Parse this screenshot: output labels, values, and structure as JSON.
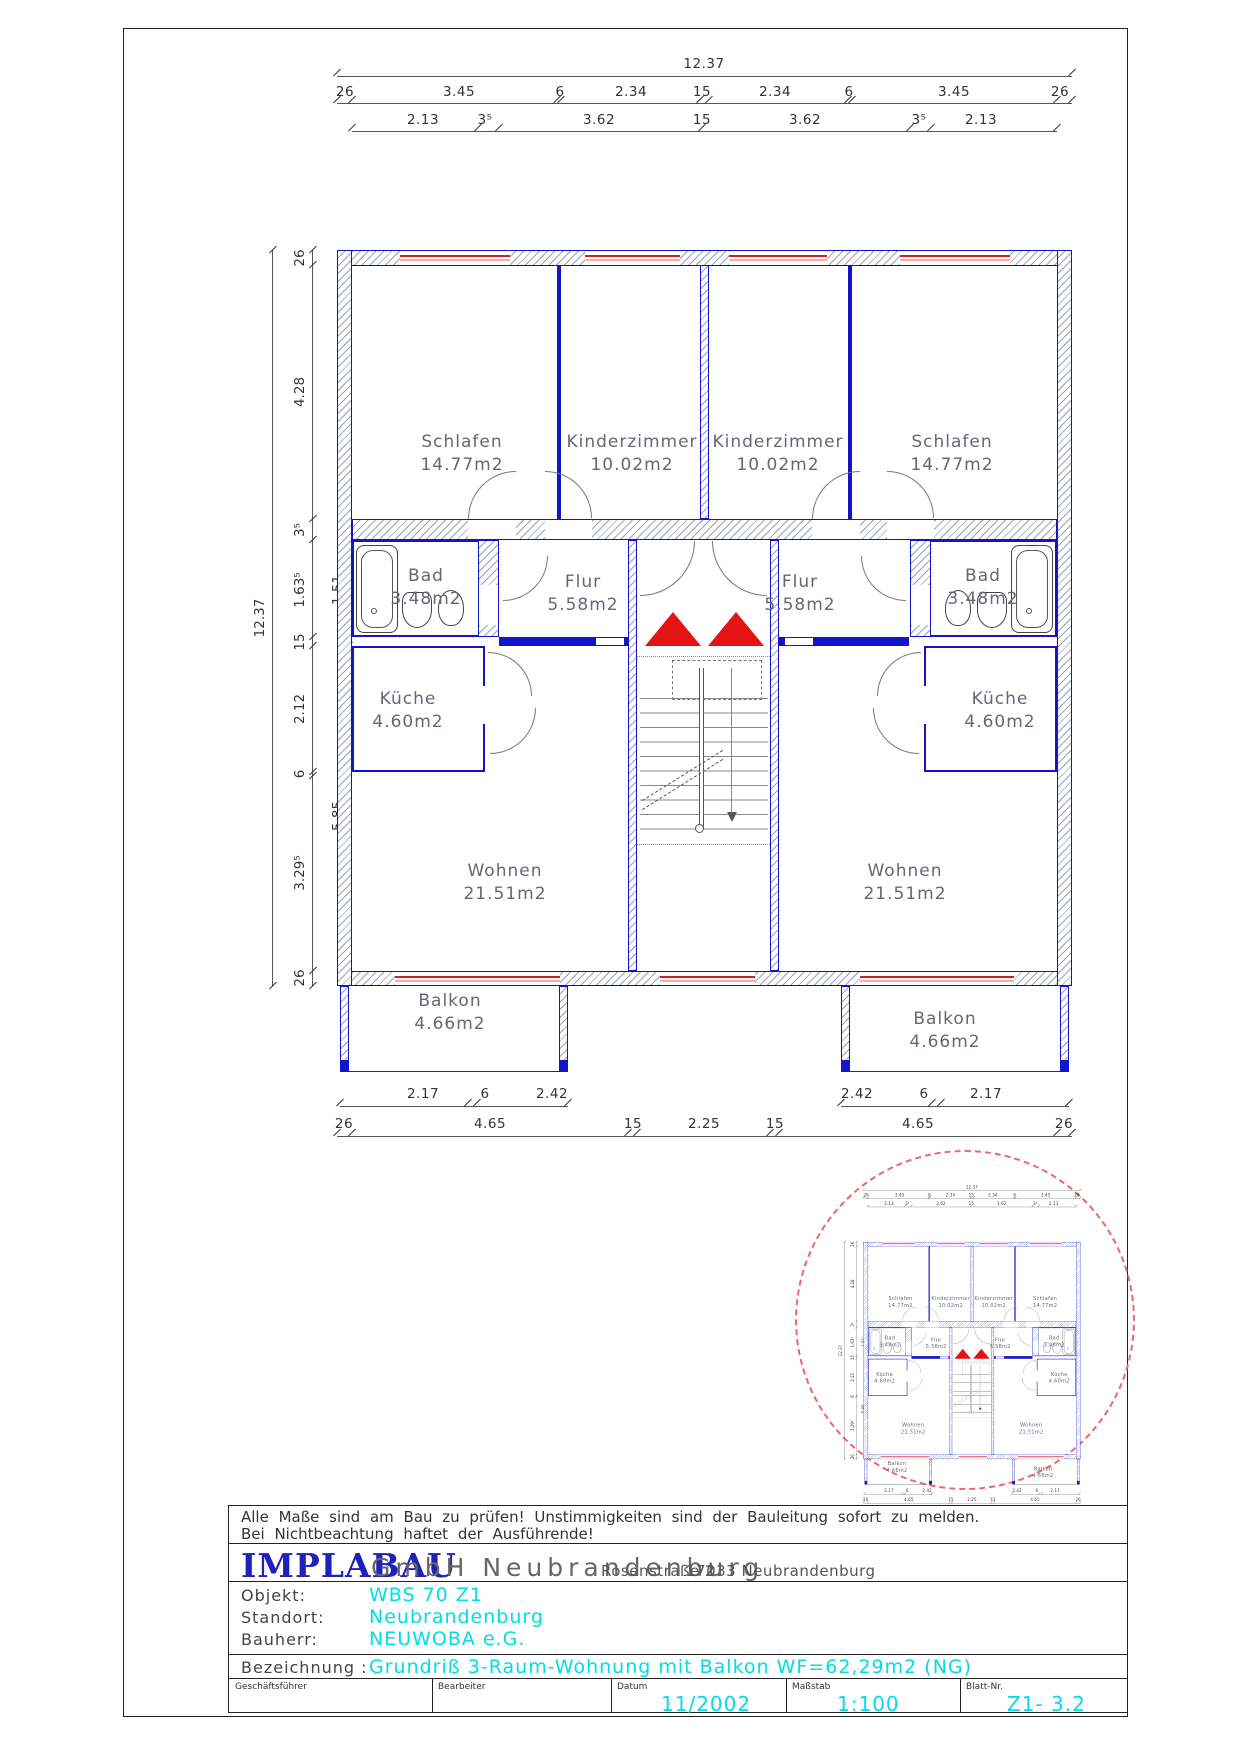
{
  "dims": {
    "top_overall": "12.37",
    "top_row2": [
      "26",
      "3.45",
      "6",
      "2.34",
      "15",
      "2.34",
      "6",
      "3.45",
      "26"
    ],
    "top_row3": [
      "2.13",
      "3⁵",
      "3.62",
      "15",
      "3.62",
      "3⁵",
      "2.13"
    ],
    "left_overall": "12.37",
    "left_chain": [
      "26",
      "4.28",
      "3⁵",
      "1.63⁵",
      "15",
      "2.12",
      "6",
      "3.29⁵",
      "26"
    ],
    "left_inner": [
      "1.51",
      "5.85"
    ],
    "bottom_row1_left": [
      "2.17",
      "6",
      "2.42"
    ],
    "bottom_row1_right": [
      "2.42",
      "6",
      "2.17"
    ],
    "bottom_row2": [
      "26",
      "4.65",
      "15",
      "2.25",
      "15",
      "4.65",
      "26"
    ]
  },
  "rooms": {
    "schlafen_l": {
      "name": "Schlafen",
      "area": "14.77m2"
    },
    "kinder_l": {
      "name": "Kinderzimmer",
      "area": "10.02m2"
    },
    "kinder_r": {
      "name": "Kinderzimmer",
      "area": "10.02m2"
    },
    "schlafen_r": {
      "name": "Schlafen",
      "area": "14.77m2"
    },
    "bad_l": {
      "name": "Bad",
      "area": "3.48m2"
    },
    "flur_l": {
      "name": "Flur",
      "area": "5.58m2"
    },
    "flur_r": {
      "name": "Flur",
      "area": "5.58m2"
    },
    "bad_r": {
      "name": "Bad",
      "area": "3.48m2"
    },
    "kueche_l": {
      "name": "Küche",
      "area": "4.60m2"
    },
    "kueche_r": {
      "name": "Küche",
      "area": "4.60m2"
    },
    "wohnen_l": {
      "name": "Wohnen",
      "area": "21.51m2"
    },
    "wohnen_r": {
      "name": "Wohnen",
      "area": "21.51m2"
    },
    "balkon_l": {
      "name": "Balkon",
      "area": "4.66m2"
    },
    "balkon_r": {
      "name": "Balkon",
      "area": "4.66m2"
    }
  },
  "warning": {
    "line1": "Alle Maße sind am Bau zu prüfen! Unstimmigkeiten sind der Bauleitung sofort zu melden.",
    "line2": "Bei Nichtbeachtung haftet der Ausführende!"
  },
  "titleblock": {
    "company": "IMPLABAU",
    "company_suffix": "GmbH Neubrandenburg",
    "address_street": "Rosenstraße 2",
    "address_city": "17033 Neubrandenburg",
    "objekt_label": "Objekt:",
    "objekt": "WBS 70 Z1",
    "standort_label": "Standort:",
    "standort": "Neubrandenburg",
    "bauherr_label": "Bauherr:",
    "bauherr": "NEUWOBA e.G.",
    "bezeichnung_label": "Bezeichnung :",
    "bezeichnung": "Grundriß 3-Raum-Wohnung mit Balkon WF=62,29m2  (NG)",
    "geschaeftsfuehrer_label": "Geschäftsführer",
    "bearbeiter_label": "Bearbeiter",
    "datum_label": "Datum",
    "datum": "11/2002",
    "massstab_label": "Maßstab",
    "massstab": "1:100",
    "blattnr_label": "Blatt-Nr.",
    "blattnr": "Z1- 3.2"
  },
  "colors": {
    "wall_blue": "#1414cc",
    "window_red": "#cc2222",
    "window_pink": "#ffaaaa",
    "triangle_red": "#e41414",
    "highlight_cyan": "#00dde6",
    "brand_blue": "#2020bb",
    "circle_red": "#e66666"
  }
}
